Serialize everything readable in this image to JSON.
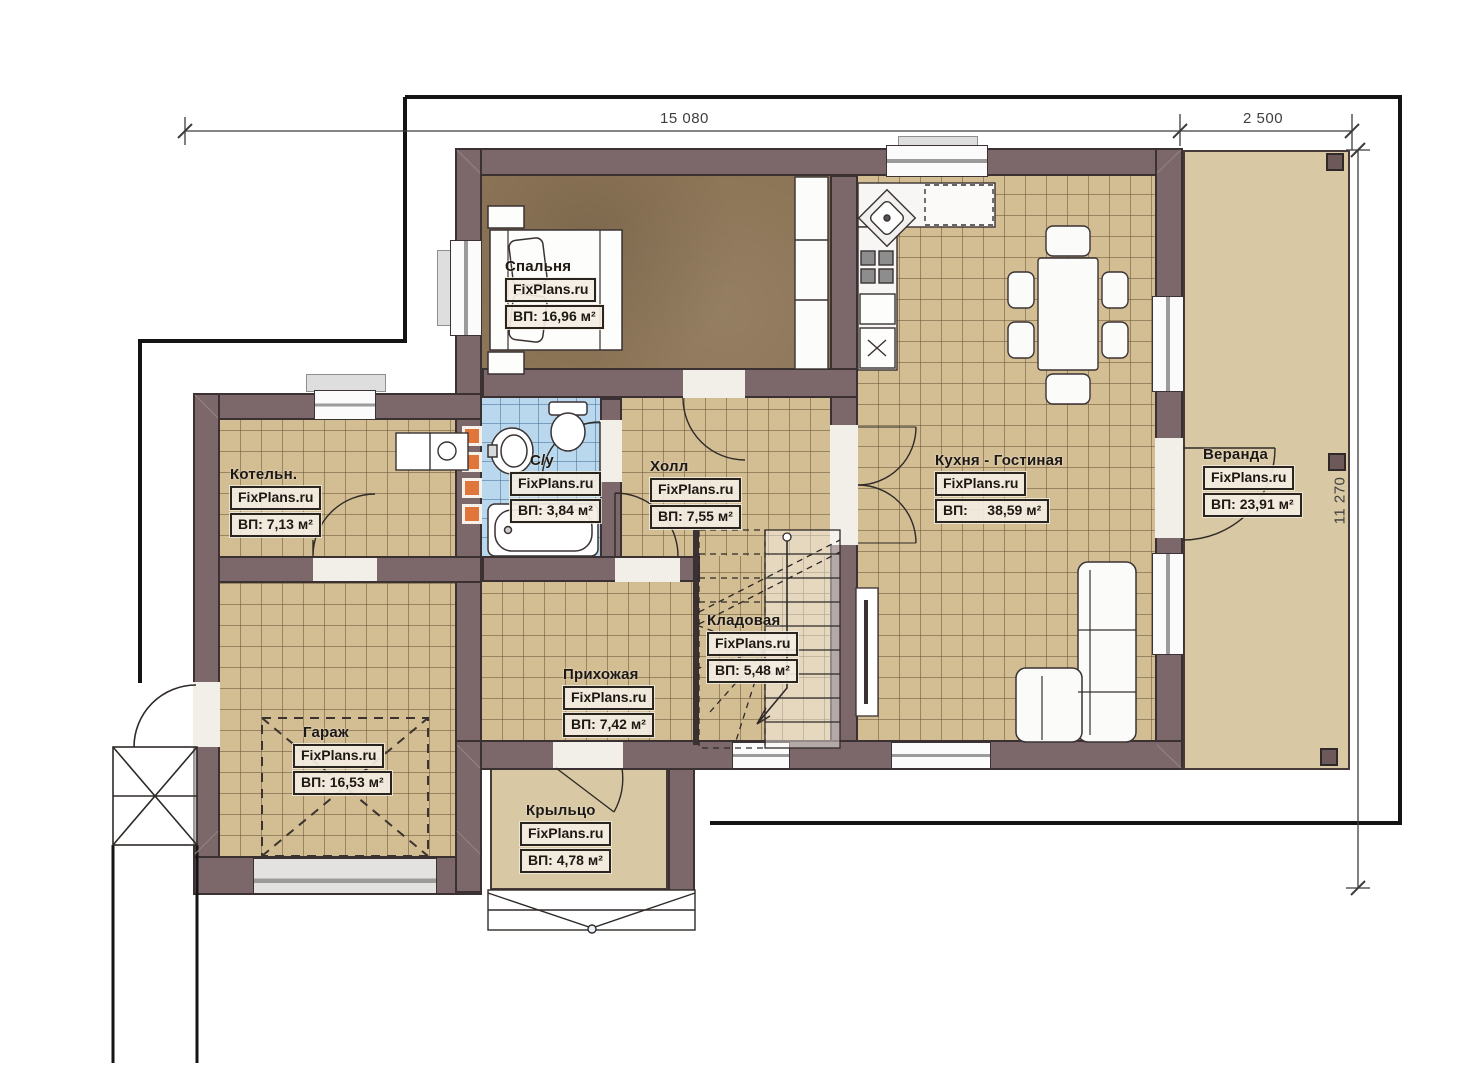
{
  "brand": "FixPlans.ru",
  "dimensions": {
    "top": "15 080",
    "top_right": "2 500",
    "right": "11 270"
  },
  "rooms": [
    {
      "name": "Спальня",
      "area": "ВП: 16,96 м²"
    },
    {
      "name": "Котельн.",
      "area": "ВП: 7,13 м²"
    },
    {
      "name": "С/у",
      "area": "ВП: 3,84 м²"
    },
    {
      "name": "Холл",
      "area": "ВП: 7,55 м²"
    },
    {
      "name": "Кухня - Гостиная",
      "area": "ВП:     38,59 м²"
    },
    {
      "name": "Веранда",
      "area": "ВП: 23,91 м²"
    },
    {
      "name": "Кладовая",
      "area": "ВП: 5,48 м²"
    },
    {
      "name": "Прихожая",
      "area": "ВП: 7,42 м²"
    },
    {
      "name": "Гараж",
      "area": "ВП: 16,53 м²"
    },
    {
      "name": "Крыльцо",
      "area": "ВП: 4,78 м²"
    }
  ],
  "colors": {
    "wall": "#7c686a",
    "floor_tile": "#d3bd93",
    "bathroom_tile": "#b9d8ee",
    "bedroom_floor": "#8d7557",
    "veranda_floor": "#d8c8a3",
    "vent_accent": "#e0763c",
    "boundary_line": "#141414"
  }
}
